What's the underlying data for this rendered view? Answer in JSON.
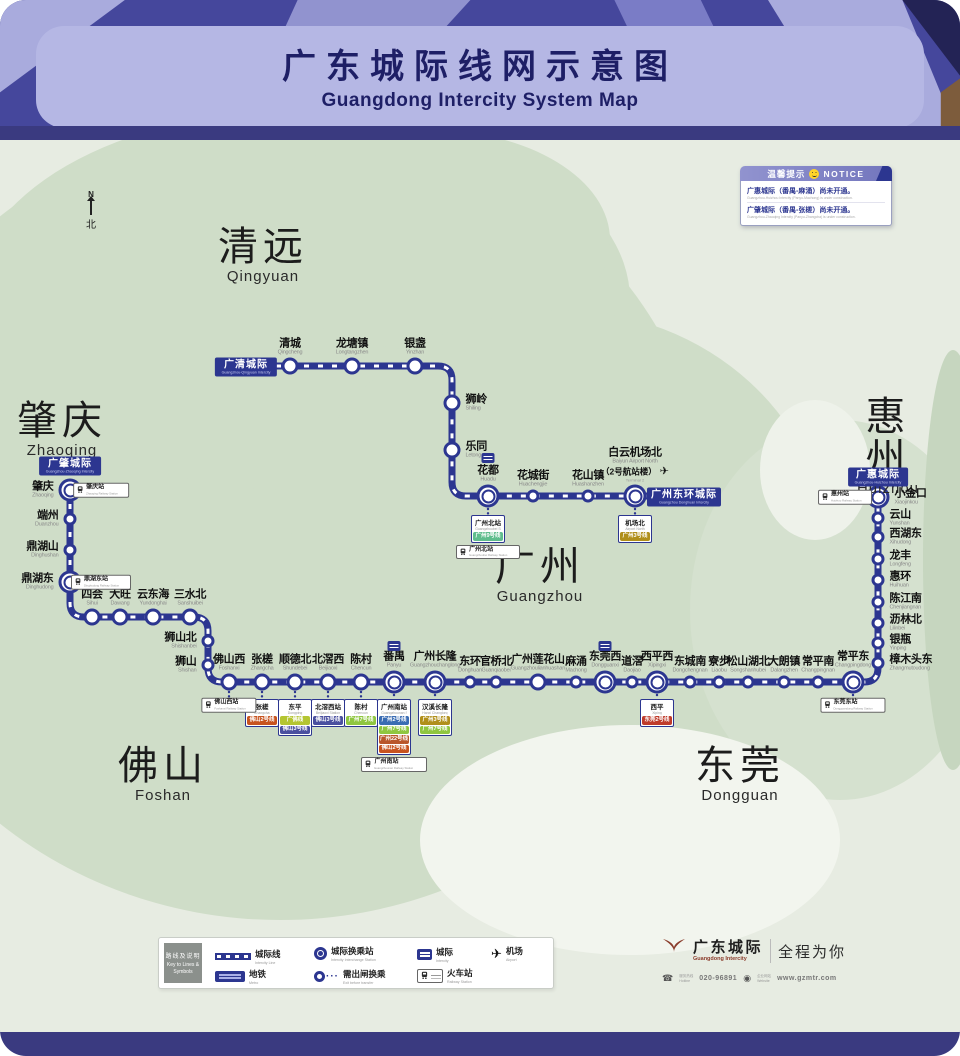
{
  "title": {
    "zh": "广东城际线网示意图",
    "en": "Guangdong Intercity System Map"
  },
  "compass": {
    "n": "N",
    "north": "北"
  },
  "colors": {
    "rail": "#2c3690",
    "rail_tie": "#ffffff",
    "land": "#cfddc8"
  },
  "notice": {
    "header_zh": "温馨提示",
    "header_en": "NOTICE",
    "lines": [
      {
        "zh": "广惠城际（番禺-麻涌）尚未开通。",
        "en": "Guangzhou-Huizhou Intercity (Panyu-Machong) is under construction."
      },
      {
        "zh": "广肇城际（番禺-张槎）尚未开通。",
        "en": "Guangzhou-Zhaoqing Intercity (Panyu-Zhangcha) is under construction."
      }
    ]
  },
  "regions": [
    {
      "zh": "清远",
      "en": "Qingyuan",
      "x": 263,
      "y": 226
    },
    {
      "zh": "肇庆",
      "en": "Zhaoqing",
      "x": 62,
      "y": 400
    },
    {
      "zh": "惠州",
      "en": "Huizhou",
      "x": 888,
      "y": 396
    },
    {
      "zh": "广州",
      "en": "Guangzhou",
      "x": 540,
      "y": 546
    },
    {
      "zh": "佛山",
      "en": "Foshan",
      "x": 163,
      "y": 745
    },
    {
      "zh": "东莞",
      "en": "Dongguan",
      "x": 740,
      "y": 745
    }
  ],
  "line_labels": [
    {
      "zh": "广清城际",
      "en": "Guangzhou-Qingyuan Intercity",
      "x": 246,
      "y": 367
    },
    {
      "zh": "广肇城际",
      "en": "Guangzhou-Zhaoqing Intercity",
      "x": 70,
      "y": 466
    },
    {
      "zh": "广惠城际",
      "en": "Guangzhou-Huizhou Intercity",
      "x": 878,
      "y": 477
    },
    {
      "zh": "广州东环城际",
      "en": "Guangzhou Donghuan Intercity",
      "x": 684,
      "y": 497
    }
  ],
  "map": {
    "airport_glyph": "✈",
    "rail_paths": [
      "M276 366 H438 Q452 366 452 380 V482 Q452 496 466 496 H650",
      "M70 490 V603 Q70 617 84 617 H194 Q208 617 208 631 V668 Q208 682 222 682 H864 Q878 682 878 668 V497"
    ],
    "links": [
      [
        79,
        490,
        84,
        490
      ],
      [
        79,
        582,
        84,
        582
      ],
      [
        488,
        509,
        488,
        514
      ],
      [
        635,
        509,
        635,
        514
      ],
      [
        229,
        692,
        229,
        697
      ],
      [
        262,
        692,
        262,
        697
      ],
      [
        295,
        692,
        295,
        697
      ],
      [
        328,
        692,
        328,
        697
      ],
      [
        361,
        692,
        361,
        697
      ],
      [
        394,
        695,
        394,
        698
      ],
      [
        435,
        695,
        435,
        698
      ],
      [
        657,
        695,
        657,
        698
      ],
      [
        853,
        695,
        853,
        697
      ],
      [
        861,
        497,
        866,
        497
      ]
    ],
    "stations": [
      {
        "zh": "清城",
        "en": "Qingcheng",
        "x": 290,
        "y": 366,
        "s": "m",
        "lab": "top"
      },
      {
        "zh": "龙塘镇",
        "en": "Longtangzhen",
        "x": 352,
        "y": 366,
        "s": "m",
        "lab": "top"
      },
      {
        "zh": "银盏",
        "en": "Yinzhan",
        "x": 415,
        "y": 366,
        "s": "m",
        "lab": "top"
      },
      {
        "zh": "狮岭",
        "en": "Shiling",
        "x": 452,
        "y": 403,
        "s": "m",
        "lab": "right"
      },
      {
        "zh": "乐同",
        "en": "Letong",
        "x": 452,
        "y": 450,
        "s": "m",
        "lab": "right"
      },
      {
        "zh": "花都",
        "en": "Huadu",
        "x": 488,
        "y": 496,
        "s": "l",
        "lab": "top"
      },
      {
        "zh": "花城街",
        "en": "Huachengjie",
        "x": 533,
        "y": 496,
        "s": "s",
        "lab": "top"
      },
      {
        "zh": "花山镇",
        "en": "Huashanzhen",
        "x": 588,
        "y": 496,
        "s": "s",
        "lab": "top"
      },
      {
        "zh": "白云机场北",
        "en": "Baiyun Airport North",
        "x": 635,
        "y": 496,
        "s": "l",
        "lab": "airport",
        "sub": "（2号航站楼）",
        "sub_en": "Terminal 2"
      },
      {
        "zh": "肇庆",
        "en": "Zhaoqing",
        "x": 70,
        "y": 490,
        "s": "l",
        "lab": "left"
      },
      {
        "zh": "端州",
        "en": "Duanzhou",
        "x": 70,
        "y": 519,
        "s": "s",
        "lab": "left"
      },
      {
        "zh": "鼎湖山",
        "en": "Dinghushan",
        "x": 70,
        "y": 550,
        "s": "s",
        "lab": "left"
      },
      {
        "zh": "鼎湖东",
        "en": "Dinghudong",
        "x": 70,
        "y": 582,
        "s": "l",
        "lab": "left"
      },
      {
        "zh": "四会",
        "en": "Sihui",
        "x": 92,
        "y": 617,
        "s": "m",
        "lab": "top"
      },
      {
        "zh": "大旺",
        "en": "Dawang",
        "x": 120,
        "y": 617,
        "s": "m",
        "lab": "top"
      },
      {
        "zh": "云东海",
        "en": "Yundonghai",
        "x": 153,
        "y": 617,
        "s": "m",
        "lab": "top"
      },
      {
        "zh": "三水北",
        "en": "Sanshuibei",
        "x": 190,
        "y": 617,
        "s": "m",
        "lab": "top"
      },
      {
        "zh": "狮山北",
        "en": "Shishanbei",
        "x": 208,
        "y": 641,
        "s": "s",
        "lab": "left"
      },
      {
        "zh": "狮山",
        "en": "Shishan",
        "x": 208,
        "y": 665,
        "s": "s",
        "lab": "left"
      },
      {
        "zh": "佛山西",
        "en": "Foshanxi",
        "x": 229,
        "y": 682,
        "s": "m",
        "lab": "top"
      },
      {
        "zh": "张槎",
        "en": "Zhangcha",
        "x": 262,
        "y": 682,
        "s": "m",
        "lab": "top"
      },
      {
        "zh": "顺德北",
        "en": "Shundebei",
        "x": 295,
        "y": 682,
        "s": "m",
        "lab": "top"
      },
      {
        "zh": "北滘西",
        "en": "Beijiaoxi",
        "x": 328,
        "y": 682,
        "s": "m",
        "lab": "top"
      },
      {
        "zh": "陈村",
        "en": "Chencun",
        "x": 361,
        "y": 682,
        "s": "m",
        "lab": "top"
      },
      {
        "zh": "番禺",
        "en": "Panyu",
        "x": 394,
        "y": 682,
        "s": "l",
        "lab": "top"
      },
      {
        "zh": "广州长隆",
        "en": "Guangzhouchanglong",
        "x": 435,
        "y": 682,
        "s": "l",
        "lab": "top"
      },
      {
        "zh": "东环",
        "en": "Donghuan",
        "x": 470,
        "y": 682,
        "s": "s",
        "lab": "top"
      },
      {
        "zh": "官桥北",
        "en": "Guanqiaobei",
        "x": 496,
        "y": 682,
        "s": "s",
        "lab": "top"
      },
      {
        "zh": "广州莲花山",
        "en": "Guangzhoulianhuashan",
        "x": 538,
        "y": 682,
        "s": "m",
        "lab": "top"
      },
      {
        "zh": "麻涌",
        "en": "Machong",
        "x": 576,
        "y": 682,
        "s": "s",
        "lab": "top"
      },
      {
        "zh": "东莞西",
        "en": "Dongguanxi",
        "x": 605,
        "y": 682,
        "s": "l",
        "lab": "top"
      },
      {
        "zh": "道滘",
        "en": "Daojiao",
        "x": 632,
        "y": 682,
        "s": "s",
        "lab": "top"
      },
      {
        "zh": "西平西",
        "en": "Xipingxi",
        "x": 657,
        "y": 682,
        "s": "l",
        "lab": "top"
      },
      {
        "zh": "东城南",
        "en": "Dongchengnan",
        "x": 690,
        "y": 682,
        "s": "s",
        "lab": "top"
      },
      {
        "zh": "寮步",
        "en": "Liaobu",
        "x": 719,
        "y": 682,
        "s": "s",
        "lab": "top"
      },
      {
        "zh": "松山湖北",
        "en": "Songshanhubei",
        "x": 748,
        "y": 682,
        "s": "s",
        "lab": "top"
      },
      {
        "zh": "大朗镇",
        "en": "Dalangzhen",
        "x": 784,
        "y": 682,
        "s": "s",
        "lab": "top"
      },
      {
        "zh": "常平南",
        "en": "Changpingnan",
        "x": 818,
        "y": 682,
        "s": "s",
        "lab": "top"
      },
      {
        "zh": "常平东",
        "en": "Changpingdong",
        "x": 853,
        "y": 682,
        "s": "l",
        "lab": "top"
      },
      {
        "zh": "樟木头东",
        "en": "Zhangmutoudong",
        "x": 878,
        "y": 663,
        "s": "s",
        "lab": "right"
      },
      {
        "zh": "银瓶",
        "en": "Yinping",
        "x": 878,
        "y": 643,
        "s": "s",
        "lab": "right"
      },
      {
        "zh": "沥林北",
        "en": "Lilinbei",
        "x": 878,
        "y": 623,
        "s": "s",
        "lab": "right"
      },
      {
        "zh": "陈江南",
        "en": "Chenjiangnan",
        "x": 878,
        "y": 602,
        "s": "s",
        "lab": "right"
      },
      {
        "zh": "惠环",
        "en": "Huihuan",
        "x": 878,
        "y": 580,
        "s": "s",
        "lab": "right"
      },
      {
        "zh": "龙丰",
        "en": "Longfeng",
        "x": 878,
        "y": 559,
        "s": "s",
        "lab": "right"
      },
      {
        "zh": "西湖东",
        "en": "Xihudong",
        "x": 878,
        "y": 537,
        "s": "s",
        "lab": "right"
      },
      {
        "zh": "云山",
        "en": "Yunshan",
        "x": 878,
        "y": 518,
        "s": "s",
        "lab": "right"
      },
      {
        "zh": "小金口",
        "en": "Xiaojinkou",
        "x": 878,
        "y": 497,
        "s": "l",
        "lab": "right"
      }
    ],
    "transfer_boxes": [
      {
        "x": 488,
        "y": 515,
        "title": "广州北站",
        "en": "Guangzhoubei Station",
        "chips": [
          {
            "zh": "广州9号线",
            "c": "#5fbd8d"
          }
        ],
        "railway": {
          "zh": "广州北站",
          "en": "Guangzhoubei Railway Station"
        }
      },
      {
        "x": 635,
        "y": 515,
        "title": "机场北",
        "en": "Airport North",
        "chips": [
          {
            "zh": "广州3号线",
            "c": "#b08f1b"
          }
        ]
      },
      {
        "x": 262,
        "y": 699,
        "title": "张槎",
        "en": "Zhangcha",
        "chips": [
          {
            "zh": "佛山2号线",
            "c": "#c7531f"
          }
        ]
      },
      {
        "x": 295,
        "y": 699,
        "title": "东平",
        "en": "Dongping",
        "chips": [
          {
            "zh": "广佛线",
            "c": "#b4c531"
          },
          {
            "zh": "佛山3号线",
            "c": "#4a4f9f"
          }
        ]
      },
      {
        "x": 328,
        "y": 699,
        "title": "北滘西站",
        "en": "Beijiaoxi Station",
        "chips": [
          {
            "zh": "佛山3号线",
            "c": "#4a4f9f"
          }
        ]
      },
      {
        "x": 361,
        "y": 699,
        "title": "陈村",
        "en": "Chencun",
        "chips": [
          {
            "zh": "广州7号线",
            "c": "#8fc640"
          }
        ]
      },
      {
        "x": 394,
        "y": 699,
        "title": "广州南站",
        "en": "Guangzhounan Station",
        "chips": [
          {
            "zh": "广州2号线",
            "c": "#3a6cb3"
          },
          {
            "zh": "广州7号线",
            "c": "#8fc640"
          },
          {
            "zh": "广州22号线",
            "c": "#b9562b"
          },
          {
            "zh": "佛山2号线",
            "c": "#c7531f"
          }
        ],
        "railway": {
          "zh": "广州南站",
          "en": "Guangzhounan Railway Station"
        }
      },
      {
        "x": 435,
        "y": 699,
        "title": "汉溪长隆",
        "en": "Hanxi Changlong",
        "chips": [
          {
            "zh": "广州3号线",
            "c": "#b08f1b"
          },
          {
            "zh": "广州7号线",
            "c": "#8fc640"
          }
        ]
      },
      {
        "x": 657,
        "y": 699,
        "title": "西平",
        "en": "Xiping",
        "chips": [
          {
            "zh": "东莞2号线",
            "c": "#bf3b2b"
          }
        ]
      }
    ],
    "railway_boxes": [
      {
        "x": 101,
        "y": 490,
        "zh": "肇庆站",
        "en": "Zhaoqing Railway Station"
      },
      {
        "x": 101,
        "y": 582,
        "zh": "鼎湖东站",
        "en": "Dinghudong Railway Station"
      },
      {
        "x": 229,
        "y": 705,
        "zh": "佛山西站",
        "en": "Foshanxi Railway Station"
      },
      {
        "x": 853,
        "y": 705,
        "zh": "东莞东站",
        "en": "Dongguandong Railway Station"
      },
      {
        "x": 845,
        "y": 497,
        "zh": "惠州站",
        "en": "Huizhou Railway Station"
      }
    ],
    "intercity_icons": [
      {
        "x": 488,
        "y": 458
      },
      {
        "x": 394,
        "y": 646
      },
      {
        "x": 605,
        "y": 646
      }
    ]
  },
  "legend": {
    "key_zh": "路线及说明",
    "key_en": "Key to Lines & Symbols",
    "items": [
      {
        "zh": "城际线",
        "en": "Intercity Line"
      },
      {
        "zh": "城际换乘站",
        "en": "Intercity Interchange Station"
      },
      {
        "zh": "城际",
        "en": "Intercity"
      },
      {
        "zh": "机场",
        "en": "Airport"
      },
      {
        "zh": "地铁",
        "en": "Metro"
      },
      {
        "zh": "需出闸换乘",
        "en": "Exit before transfer"
      },
      {
        "zh": "火车站",
        "en": "Railway Station"
      }
    ]
  },
  "branding": {
    "name_zh": "广东城际",
    "name_en": "Guangdong Intercity",
    "slogan": "全程为你",
    "hotline_label_zh": "服务热线",
    "hotline_label_en": "Hotline",
    "hotline": "020-96891",
    "web_label_zh": "企业网站",
    "web_label_en": "Website",
    "website": "www.gzmtr.com"
  }
}
